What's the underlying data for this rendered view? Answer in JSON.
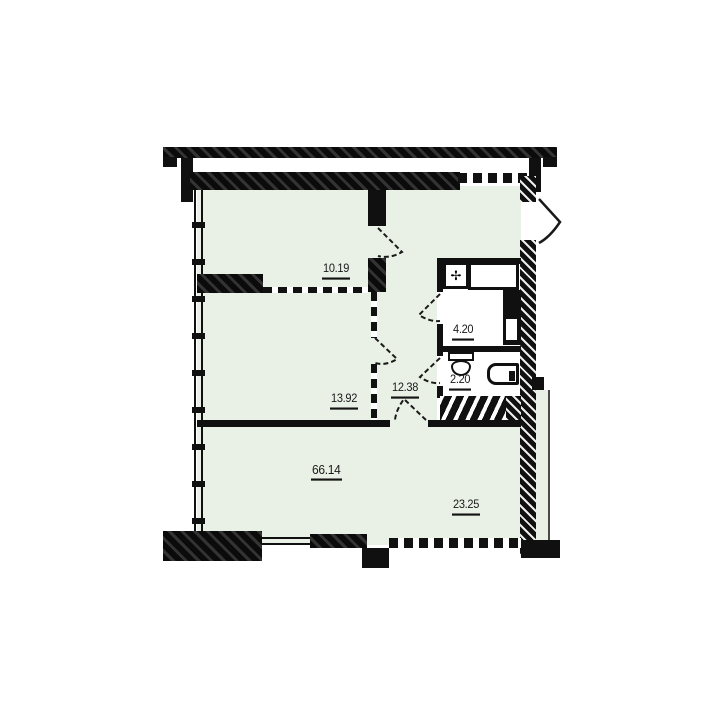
{
  "plan": {
    "type": "apartment-floor-plan",
    "rooms": [
      {
        "name": "bedroom-top",
        "area": "10.19"
      },
      {
        "name": "bedroom-middle",
        "area": "13.92"
      },
      {
        "name": "hallway",
        "area": "12.38"
      },
      {
        "name": "bathroom",
        "area": "4.20"
      },
      {
        "name": "wc",
        "area": "2.20"
      },
      {
        "name": "total-area",
        "area": "66.14"
      },
      {
        "name": "living-room",
        "area": "23.25"
      }
    ],
    "icons": {
      "vent": "✢"
    },
    "colors": {
      "floor": "#e9f0e5",
      "wall": "#101010",
      "paper": "#ffffff"
    }
  }
}
